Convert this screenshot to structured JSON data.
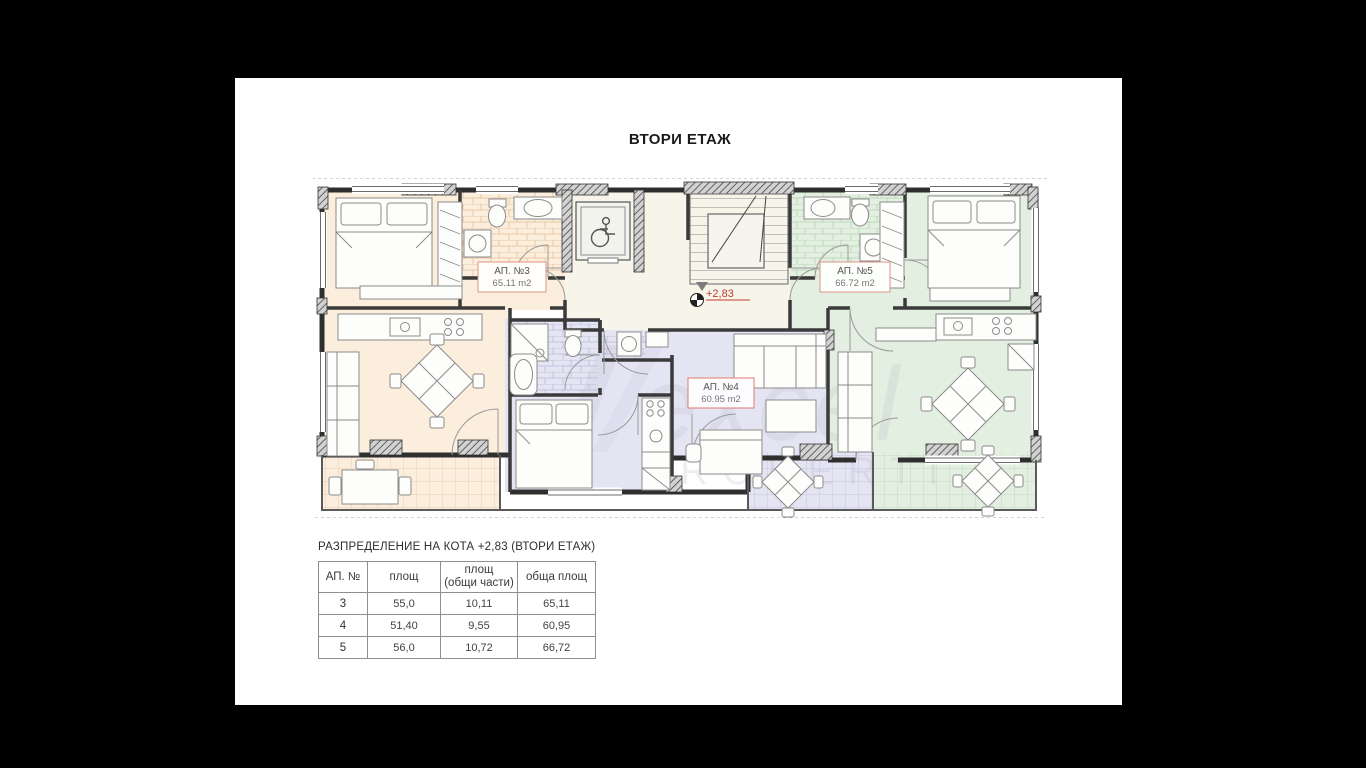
{
  "page": {
    "title": "ВТОРИ ЕТАЖ"
  },
  "plan": {
    "level_marker": "+2,83",
    "apartments": [
      {
        "label": "АП. №3",
        "area": "65.11 m2",
        "color": "#fbeedd"
      },
      {
        "label": "АП. №4",
        "area": "60.95 m2",
        "color": "#e4e4f3"
      },
      {
        "label": "АП. №5",
        "area": "66.72 m2",
        "color": "#e3efe0"
      }
    ],
    "common_color": "#f7f4e9",
    "watermark": {
      "line1": "excel",
      "line2": "PROPERTI"
    }
  },
  "table": {
    "title": "РАЗПРЕДЕЛЕНИЕ НА КОТА +2,83 (ВТОРИ ЕТАЖ)",
    "headers": {
      "c1": "АП. №",
      "c2": "площ",
      "c3": "площ\n(общи части)",
      "c4": "обща площ"
    },
    "rows": [
      {
        "num": "3",
        "area": "55,0",
        "common": "10,11",
        "total": "65,11"
      },
      {
        "num": "4",
        "area": "51,40",
        "common": "9,55",
        "total": "60,95"
      },
      {
        "num": "5",
        "area": "56,0",
        "common": "10,72",
        "total": "66,72"
      }
    ]
  }
}
